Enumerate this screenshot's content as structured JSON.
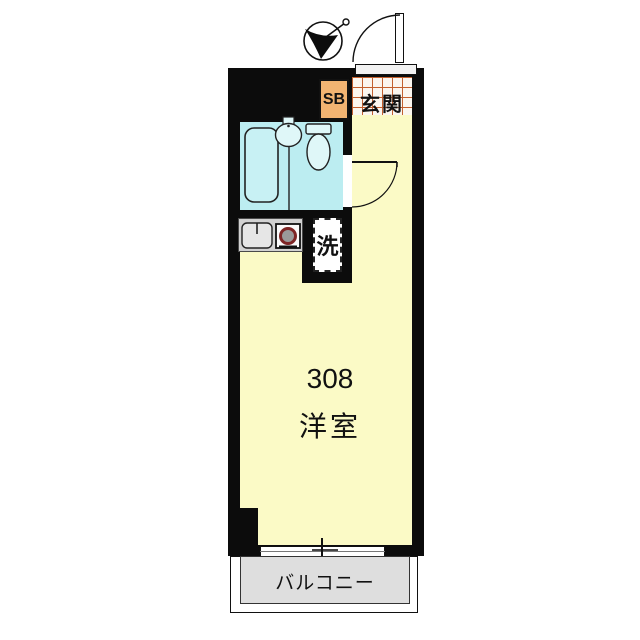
{
  "unit": {
    "number": "308",
    "room_label": "洋室"
  },
  "entrance": {
    "label": "玄関"
  },
  "shoe_box": {
    "label": "SB"
  },
  "laundry": {
    "label": "洗"
  },
  "balcony": {
    "label": "バルコニー"
  },
  "fixtures": [
    "north-arrow-icon",
    "entrance-door",
    "interior-door",
    "bathtub",
    "bathroom-sink",
    "toilet",
    "kitchen-sink",
    "stove-burner",
    "sliding-window"
  ],
  "colors": {
    "wall": "#0c0c0c",
    "room_yellow": "#FBFAC6",
    "bath_cyan": "#BCEDF1",
    "sb_orange": "#F2B472",
    "tile_grid_line": "#C2602F",
    "tile_background": "#FBF6EF",
    "balcony_gray": "#DEDEDE",
    "kitchen_gray": "#D2D2D2",
    "burner_ring_red": "#7E2525"
  }
}
